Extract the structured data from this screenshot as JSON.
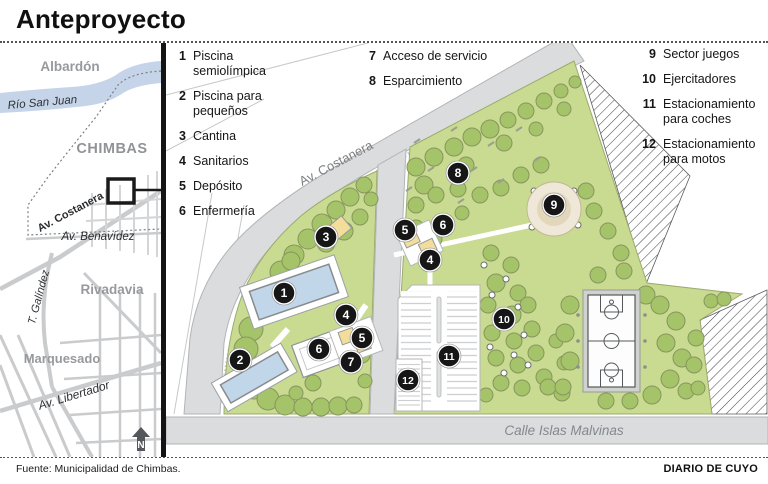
{
  "header": {
    "title": "Anteproyecto"
  },
  "locator": {
    "albardon": "Albardón",
    "rio_san_juan": "Río San Juan",
    "chimbas": "CHIMBAS",
    "av_costanera": "Av. Costanera",
    "av_benavidez": "Av. Benavídez",
    "rivadavia": "Rivadavia",
    "t_galindez": "T. Galíndez",
    "marquesado": "Marquesado",
    "av_libertador": "Av. Libertador",
    "north": "N"
  },
  "legend": {
    "columns": [
      [
        {
          "n": "1",
          "label": "Piscina semiolímpica"
        },
        {
          "n": "2",
          "label": "Piscina para pequeños"
        },
        {
          "n": "3",
          "label": "Cantina"
        },
        {
          "n": "4",
          "label": "Sanitarios"
        },
        {
          "n": "5",
          "label": "Depósito"
        },
        {
          "n": "6",
          "label": "Enfermería"
        }
      ],
      [
        {
          "n": "7",
          "label": "Acceso de servicio"
        },
        {
          "n": "8",
          "label": "Esparcimiento"
        }
      ],
      [
        {
          "n": "9",
          "label": "Sector juegos"
        },
        {
          "n": "10",
          "label": "Ejercitadores"
        },
        {
          "n": "11",
          "label": "Estacionamiento para coches"
        },
        {
          "n": "12",
          "label": "Estacionamiento para motos"
        }
      ]
    ]
  },
  "map": {
    "av_costanera_label": "Av. Costanera",
    "calle_label": "Calle Islas Malvinas",
    "markers": [
      {
        "n": "1",
        "x": 118,
        "y": 250
      },
      {
        "n": "2",
        "x": 74,
        "y": 317
      },
      {
        "n": "3",
        "x": 160,
        "y": 194
      },
      {
        "n": "4",
        "x": 180,
        "y": 272
      },
      {
        "n": "5",
        "x": 196,
        "y": 295
      },
      {
        "n": "6",
        "x": 153,
        "y": 306
      },
      {
        "n": "7",
        "x": 185,
        "y": 319
      },
      {
        "n": "4",
        "x": 264,
        "y": 217
      },
      {
        "n": "5",
        "x": 239,
        "y": 187
      },
      {
        "n": "6",
        "x": 277,
        "y": 182
      },
      {
        "n": "8",
        "x": 292,
        "y": 130
      },
      {
        "n": "9",
        "x": 388,
        "y": 162
      },
      {
        "n": "10",
        "x": 338,
        "y": 276
      },
      {
        "n": "11",
        "x": 283,
        "y": 313
      },
      {
        "n": "12",
        "x": 242,
        "y": 337
      }
    ]
  },
  "footer": {
    "source": "Fuente: Municipalidad de Chimbas.",
    "credit": "DIARIO DE CUYO"
  },
  "colors": {
    "park_green": "#c9da91",
    "park_stroke": "#9cab6e",
    "tree_green": "#a5c368",
    "tree_stroke": "#87965f",
    "road_gray": "#dadcde",
    "road_stroke": "#b2b4b6",
    "pool_blue": "#c2d6e9",
    "building_yellow": "#f2dd9b",
    "river_blue": "#c5d4e8",
    "playground_beige": "#efe8d8",
    "marker_black": "#161616"
  }
}
